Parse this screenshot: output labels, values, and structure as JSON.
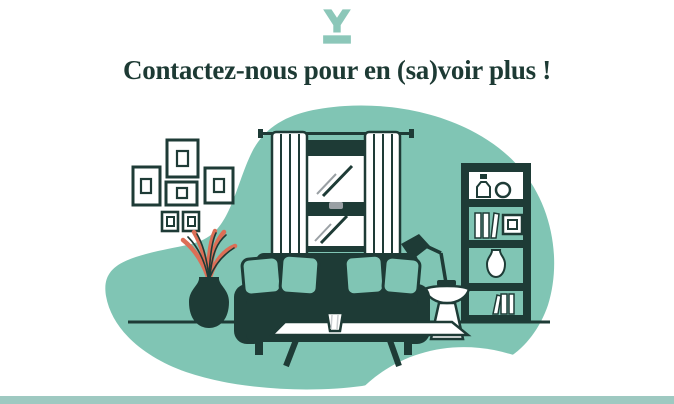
{
  "page": {
    "heading": "Contactez-nous pour en (sa)voir plus !"
  },
  "colors": {
    "teal": "#80c5b4",
    "dark": "#1e3b36",
    "coral": "#dc6e56",
    "logo": "#8cc7b9",
    "bar": "#9ec9c1",
    "heading": "#1d3a34",
    "gray": "#9aa0a4",
    "lightgray": "#c9cdd0"
  },
  "illustration": {
    "name": "living-room-scene",
    "elements": [
      "background-blob",
      "floor-line",
      "wall-frames",
      "window-with-curtains",
      "bookshelf",
      "side-table",
      "desk-lamp",
      "plant-vase",
      "sofa-with-pillows",
      "coffee-table"
    ]
  }
}
